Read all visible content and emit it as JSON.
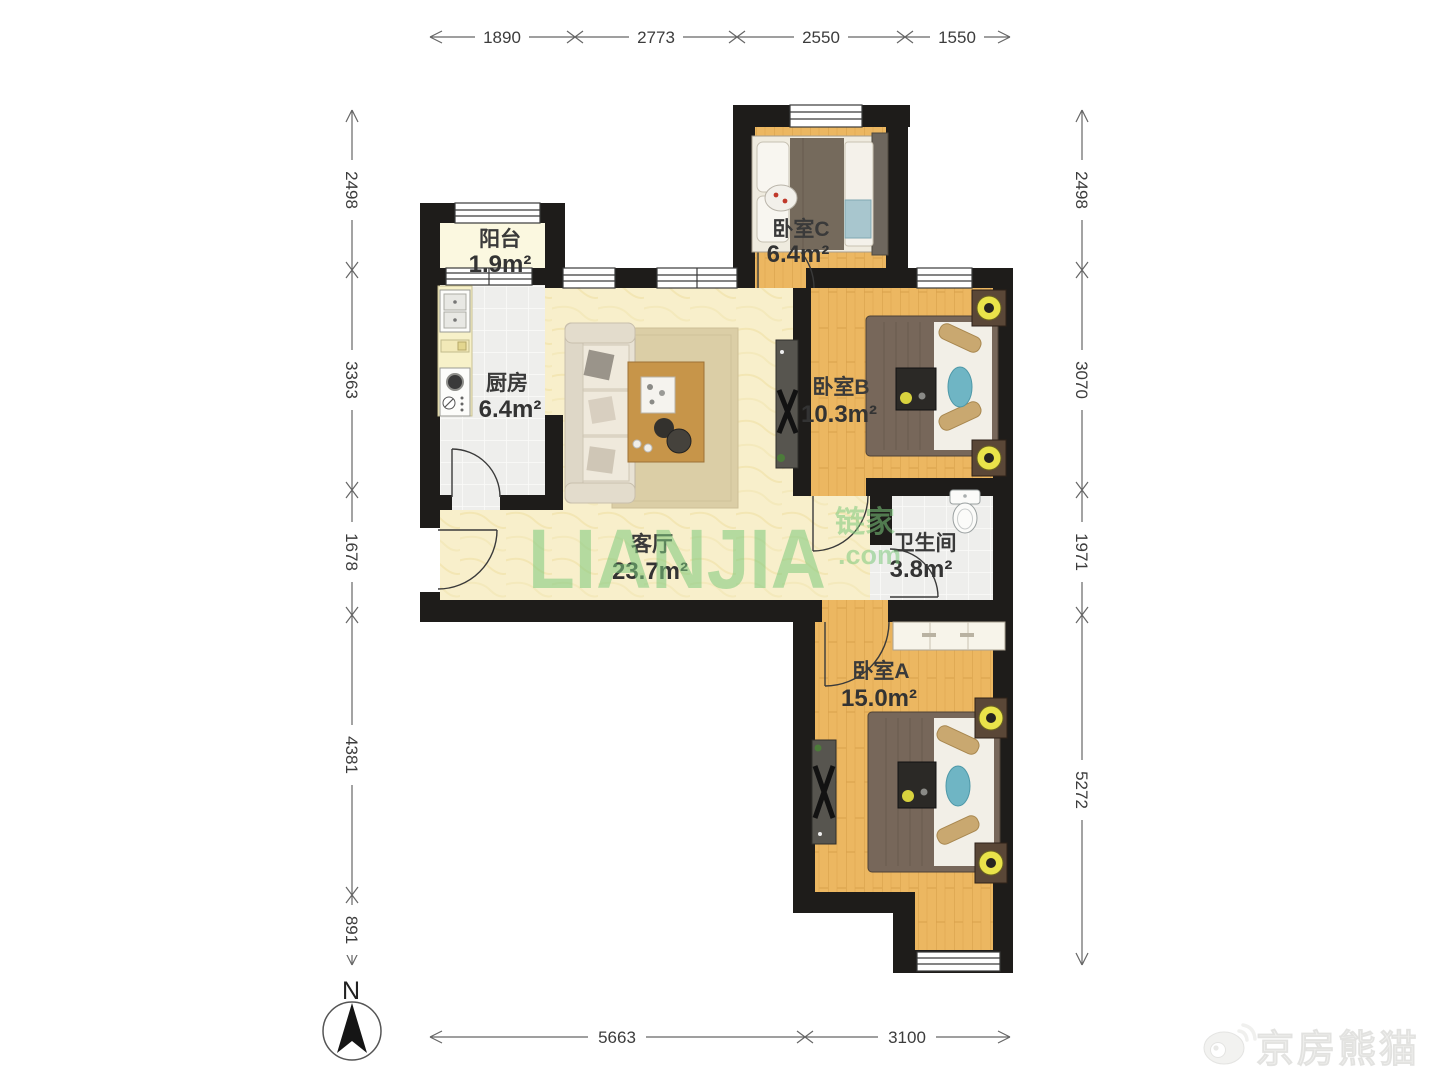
{
  "compass": {
    "label": "N"
  },
  "dimensions": {
    "top": [
      "1890",
      "2773",
      "2550",
      "1550"
    ],
    "left": [
      "2498",
      "3363",
      "1678",
      "4381",
      "891"
    ],
    "right": [
      "2498",
      "3070",
      "1971",
      "5272"
    ],
    "bottom": [
      "5663",
      "3100"
    ]
  },
  "rooms": [
    {
      "name": "阳台",
      "area": "1.9m²"
    },
    {
      "name": "厨房",
      "area": "6.4m²"
    },
    {
      "name": "客厅",
      "area": "23.7m²"
    },
    {
      "name": "卧室C",
      "area": "6.4m²"
    },
    {
      "name": "卧室B",
      "area": "10.3m²"
    },
    {
      "name": "卫生间",
      "area": "3.8m²"
    },
    {
      "name": "卧室A",
      "area": "15.0m²"
    }
  ],
  "watermark": {
    "brand": "LIANJIA",
    "brand_cn": "链家",
    "domain": ".com",
    "credit": "京房熊猫"
  },
  "colors": {
    "watermark_green": "#7CC87C",
    "wall": "#1E1C1A",
    "wood_floor": "#ECB761",
    "living_floor": "#F8EFCB",
    "tile_floor": "#EEEEEC",
    "balcony_floor": "#FBF8E0",
    "lamp_accent": "#E9E34A"
  }
}
